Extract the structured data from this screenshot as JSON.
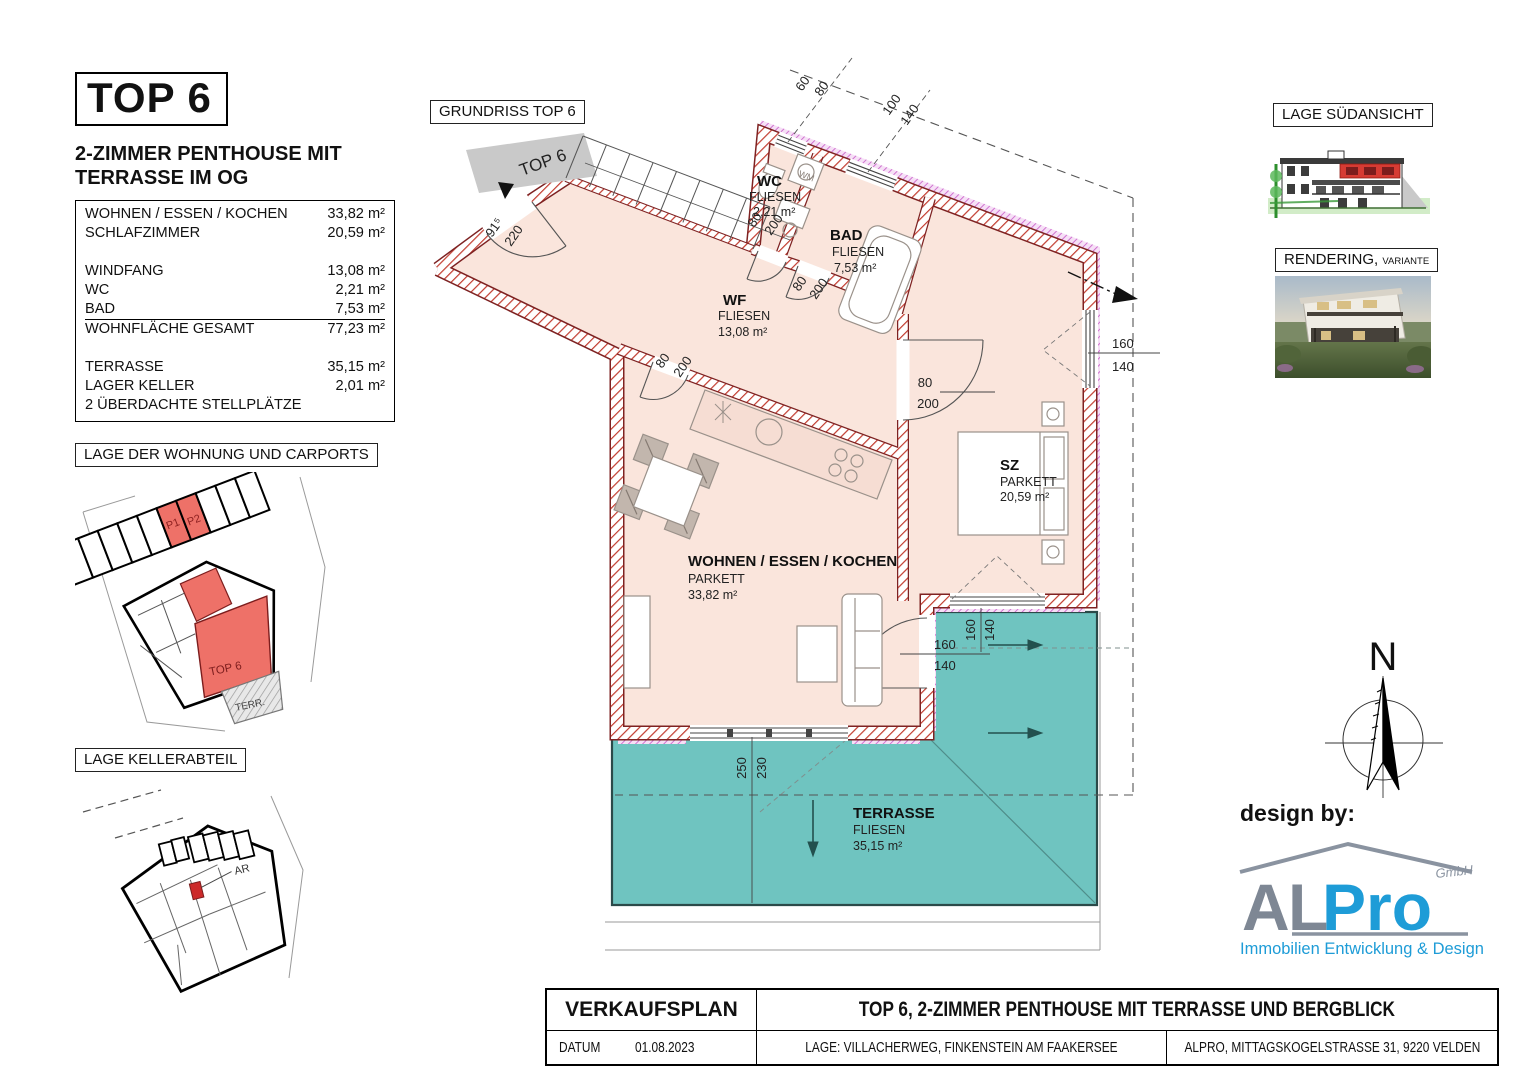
{
  "header": {
    "top_label": "TOP 6",
    "subtitle_line1": "2-ZIMMER PENTHOUSE MIT",
    "subtitle_line2": "TERRASSE IM OG"
  },
  "area_table": {
    "rows": [
      {
        "label": "WOHNEN / ESSEN / KOCHEN",
        "value": "33,82 m²"
      },
      {
        "label": "SCHLAFZIMMER",
        "value": "20,59 m²"
      },
      {
        "label": "",
        "value": ""
      },
      {
        "label": "WINDFANG",
        "value": "13,08 m²"
      },
      {
        "label": "WC",
        "value": "2,21 m²"
      },
      {
        "label": "BAD",
        "value": "7,53 m²"
      },
      {
        "label": "WOHNFLÄCHE GESAMT",
        "value": "77,23 m²"
      },
      {
        "label": "",
        "value": ""
      },
      {
        "label": "TERRASSE",
        "value": "35,15 m²"
      },
      {
        "label": "LAGER KELLER",
        "value": "2,01 m²"
      },
      {
        "label": "2 ÜBERDACHTE STELLPLÄTZE",
        "value": ""
      }
    ]
  },
  "panels": {
    "grundriss_title": "GRUNDRISS TOP 6",
    "carports_title": "LAGE DER WOHNUNG UND CARPORTS",
    "keller_title": "LAGE KELLERABTEIL",
    "suedansicht_title": "LAGE SÜDANSICHT",
    "rendering_title": "RENDERING,",
    "rendering_variant": "VARIANTE"
  },
  "site_plan": {
    "p1": "P1",
    "p2": "P2",
    "unit": "TOP 6",
    "terr": "TERR."
  },
  "keller_plan": {
    "ar_label": "AR"
  },
  "plan": {
    "entry_label": "TOP 6",
    "wm_label": "WM",
    "rooms": {
      "wc": {
        "name": "WC",
        "floor": "FLIESEN",
        "area": "2,21 m²"
      },
      "bad": {
        "name": "BAD",
        "floor": "FLIESEN",
        "area": "7,53 m²"
      },
      "wf": {
        "name": "WF",
        "floor": "FLIESEN",
        "area": "13,08 m²"
      },
      "sz": {
        "name": "SZ",
        "floor": "PARKETT",
        "area": "20,59 m²"
      },
      "wohnen": {
        "name": "WOHNEN / ESSEN / KOCHEN",
        "floor": "PARKETT",
        "area": "33,82 m²"
      },
      "terrasse": {
        "name": "TERRASSE",
        "floor": "FLIESEN",
        "area": "35,15 m²"
      }
    },
    "dims": {
      "entry_door": {
        "w": "91⁵",
        "h": "220"
      },
      "wc_door": {
        "w": "80",
        "h": "200"
      },
      "bad_door": {
        "w": "80",
        "h": "200"
      },
      "wf_door": {
        "w": "80",
        "h": "200"
      },
      "sz_door": {
        "w": "80",
        "h": "200"
      },
      "wc_window": {
        "w": "60",
        "h": "80"
      },
      "bad_window": {
        "w": "100",
        "h": "140"
      },
      "sz_window": {
        "w": "160",
        "h": "140"
      },
      "sz_terrace_window": {
        "w": "160",
        "h": "140"
      },
      "terrace_door": {
        "w": "160",
        "h": "140"
      },
      "living_window": {
        "w": "250",
        "h": "230"
      }
    }
  },
  "compass": {
    "north": "N"
  },
  "design_by": "design by:",
  "logo": {
    "a": "A",
    "l": "L",
    "pro": "Pro",
    "gmbh": "GmbH",
    "tagline": "Immobilien Entwicklung & Design",
    "gray": "#7E8794",
    "blue": "#1E9CD7"
  },
  "title_block": {
    "doc_type": "VERKAUFSPLAN",
    "title": "TOP 6, 2-ZIMMER PENTHOUSE MIT TERRASSE UND BERGBLICK",
    "datum_label": "DATUM",
    "datum_value": "01.08.2023",
    "lage": "LAGE: VILLACHERWEG, FINKENSTEIN AM FAAKERSEE",
    "firma": "ALPRO, MITTAGSKOGELSTRASSE 31, 9220 VELDEN"
  },
  "colors": {
    "floor": "#FAE5DC",
    "terrace": "#6FC4C0",
    "wall_hatch": "#C23B2E",
    "wall_edge": "#7E2222",
    "insulation": "#CC66CC",
    "highlight_red": "#E86A62"
  }
}
